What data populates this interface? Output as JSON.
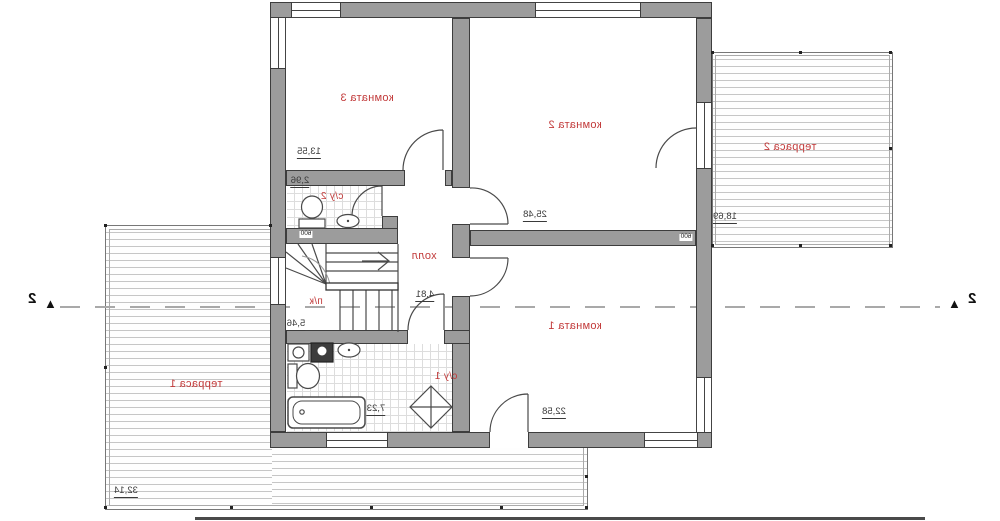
{
  "plan": {
    "type": "floor-plan-mirrored",
    "rooms": {
      "room3": {
        "label": "комната 3",
        "area": "13,55"
      },
      "room2": {
        "label": "комната 2",
        "area": "25,48"
      },
      "room1": {
        "label": "комната 1",
        "area": "22,58"
      },
      "hall": {
        "label": "холл",
        "area": "4,81"
      },
      "bath2": {
        "label": "с/у 2",
        "area": "2,96"
      },
      "bath1": {
        "label": "с/у 1",
        "area": "7,23"
      },
      "stairs": {
        "label": "п/к",
        "area": "5,46"
      },
      "terrace2": {
        "label": "терраса 2",
        "area": "18,69"
      },
      "terrace1": {
        "label": "терраса 1",
        "area": "32,14"
      }
    },
    "dims": {
      "opening1": "600",
      "opening2": "600"
    },
    "section": {
      "left_label": "2",
      "right_label": "2",
      "marker": "▲"
    },
    "colors": {
      "wall": "#9c9c9c",
      "wall_outline": "#3d3d3d",
      "room_label": "#c23a3a",
      "deck_line": "#c6c6c6"
    }
  }
}
